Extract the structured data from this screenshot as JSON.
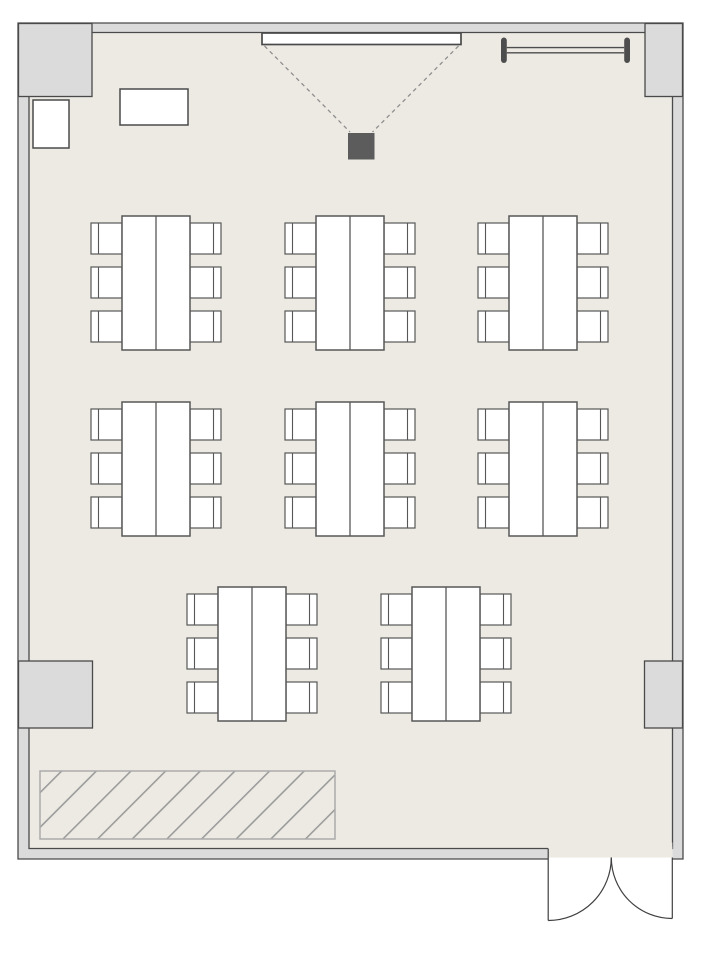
{
  "meta": {
    "type": "floor-plan",
    "description": "Classroom / seminar room floor plan with eight 6-seat table groups, projection screen, ceiling projector, coat rail, cabinets, hatched storage zone and a double entrance door",
    "canvas": {
      "width": 710,
      "height": 954
    }
  },
  "palette": {
    "page_bg": "#ffffff",
    "floor": "#EDEAE3",
    "wall_fill": "#DBDBDB",
    "wall_stroke": "#4A4A4A",
    "furniture_fill": "#FFFFFF",
    "furniture_stroke": "#575757",
    "projector_fill": "#5C5C5C",
    "beam_stroke": "#8F8F8F",
    "rail_color": "#4D4D4D",
    "hatch_border": "#ABABAB",
    "hatch_line": "#9C9C9C",
    "door_stroke": "#3F3F3F"
  },
  "room": {
    "outer": {
      "x": 18,
      "y": 23,
      "w": 665,
      "h": 836
    },
    "inner": {
      "x": 29,
      "y": 32.5,
      "w": 643.5,
      "h": 816
    },
    "pillars": [
      {
        "id": "pillar-top-left",
        "x": 18.5,
        "y": 23.5,
        "w": 73.5,
        "h": 73
      },
      {
        "id": "pillar-top-right",
        "x": 645,
        "y": 23.5,
        "w": 37.5,
        "h": 73
      },
      {
        "id": "pillar-mid-left",
        "x": 18.5,
        "y": 661,
        "w": 74,
        "h": 67
      },
      {
        "id": "pillar-mid-right",
        "x": 644.5,
        "y": 661,
        "w": 38,
        "h": 67
      }
    ],
    "door": {
      "label": "double-entrance-door",
      "opening_x1": 548.2,
      "opening_x2": 672.3,
      "wall_y": 857.5,
      "left_leaf_x": 548.2,
      "left_leaf_y2": 920.5,
      "left_radius": 63,
      "right_leaf_x": 672.3,
      "right_leaf_y2": 918.5,
      "right_radius": 61,
      "cusp_x": 611.3
    }
  },
  "fixtures": {
    "projection_screen": {
      "label": "projection-screen",
      "x": 262,
      "y": 33,
      "w": 199,
      "h": 11.5
    },
    "projector": {
      "label": "ceiling-projector",
      "x": 348,
      "y": 133,
      "w": 26.5,
      "h": 26.5
    },
    "beam_lines": [
      {
        "x1": 264.5,
        "y1": 46,
        "x2": 350,
        "y2": 132
      },
      {
        "x1": 458.5,
        "y1": 46,
        "x2": 372.5,
        "y2": 132
      }
    ],
    "coat_rail": {
      "label": "coat-rail",
      "posts": [
        {
          "x": 501,
          "y": 37.5,
          "w": 5.8,
          "h": 25.5
        },
        {
          "x": 624.2,
          "y": 37.5,
          "w": 5.8,
          "h": 25.5
        }
      ],
      "bars_y": [
        47.6,
        52.8
      ],
      "bar_x1": 506.8,
      "bar_x2": 624.2
    },
    "cabinets": [
      {
        "id": "cabinet-small",
        "x": 33,
        "y": 100,
        "w": 36,
        "h": 48
      },
      {
        "id": "cabinet-wide",
        "x": 120,
        "y": 89,
        "w": 68,
        "h": 36
      }
    ],
    "hatched_zone": {
      "label": "hatched-storage-zone",
      "x": 40,
      "y": 771,
      "w": 295,
      "h": 68,
      "hatch_spacing": 24.5,
      "hatch_width": 3.2
    }
  },
  "furniture": {
    "table_spec": {
      "table_w": 68,
      "table_h": 134,
      "chair_w": 31,
      "chair_h": 31,
      "chair_top_margin": 7,
      "chair_pitch": 44,
      "chairs_per_side": 3,
      "backrest_inset": 7.5
    },
    "groups": [
      {
        "id": "table-group-1",
        "cx": 156,
        "top": 216
      },
      {
        "id": "table-group-2",
        "cx": 350,
        "top": 216
      },
      {
        "id": "table-group-3",
        "cx": 543,
        "top": 216
      },
      {
        "id": "table-group-4",
        "cx": 156,
        "top": 402
      },
      {
        "id": "table-group-5",
        "cx": 350,
        "top": 402
      },
      {
        "id": "table-group-6",
        "cx": 543,
        "top": 402
      },
      {
        "id": "table-group-7",
        "cx": 252,
        "top": 587
      },
      {
        "id": "table-group-8",
        "cx": 446,
        "top": 587
      }
    ]
  }
}
